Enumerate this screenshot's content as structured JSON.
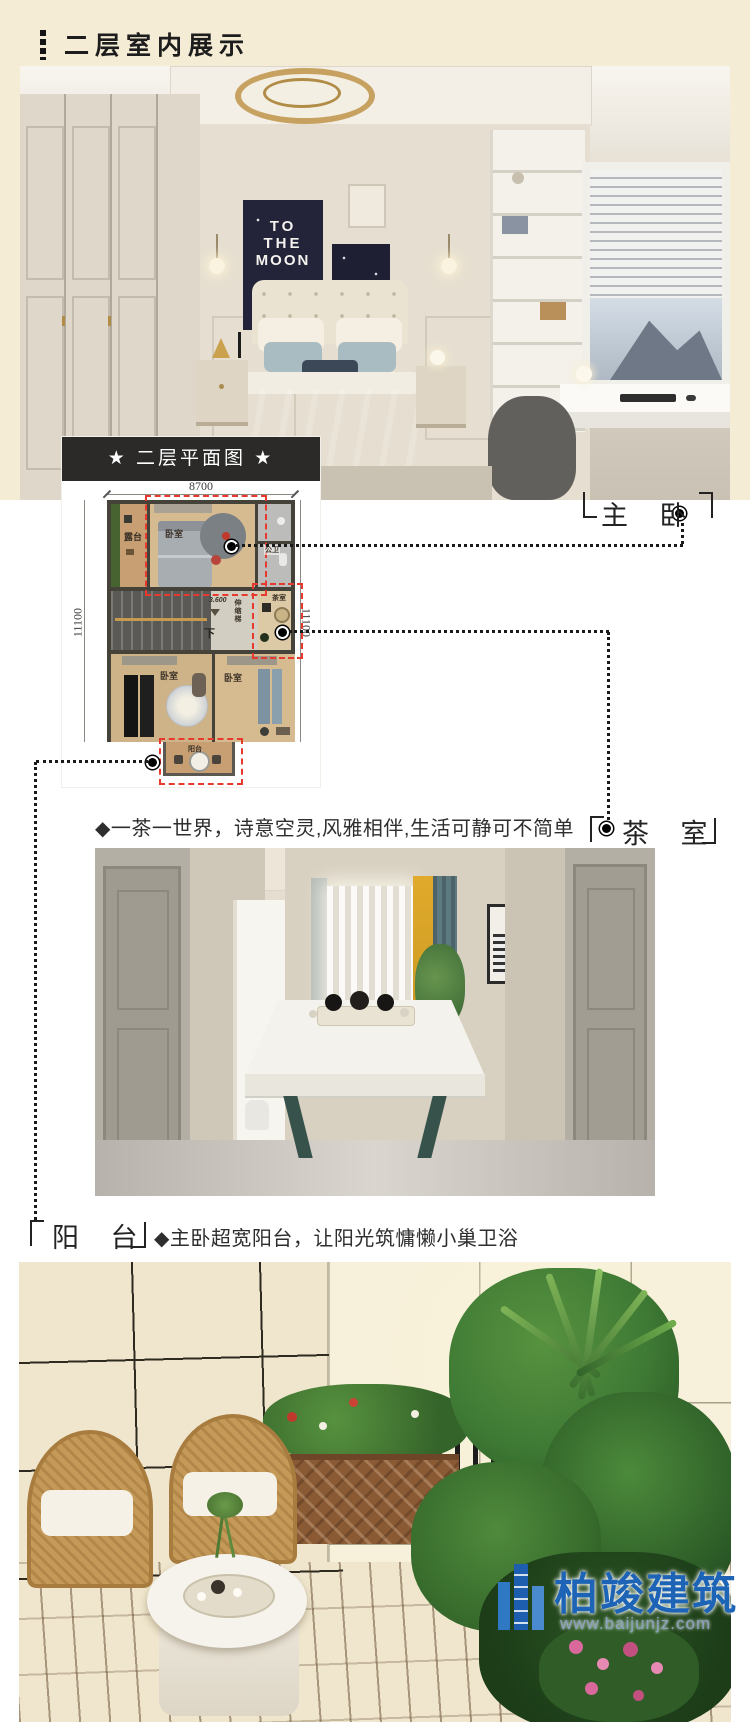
{
  "header": {
    "title": "二层室内展示"
  },
  "floorplan": {
    "title": "★ 二层平面图 ★",
    "dims": {
      "top": "8700",
      "left": "11100",
      "right": "11100"
    },
    "rooms": {
      "terrace": "露台",
      "master": "卧室",
      "bath": "公卫",
      "tea": "茶室",
      "ladder": "伸缩梯",
      "level": "3.600",
      "down": "下",
      "bedroom2": "卧室",
      "bedroom3": "卧室",
      "balcony": "阳台"
    }
  },
  "callouts": {
    "master": "主 卧",
    "tea": "茶 室",
    "balcony": "阳 台"
  },
  "captions": {
    "tea": "◆一茶一世界，诗意空灵,风雅相伴,生活可静可不简单",
    "balcony": "◆主卧超宽阳台，让阳光筑慵懒小巢卫浴"
  },
  "bedroom": {
    "poster_lines": [
      "TO",
      "THE",
      "MOON"
    ]
  },
  "watermark": {
    "brand": "柏竣建筑",
    "site": "www.baijunjz.com"
  },
  "colors": {
    "accent_red": "#e8392e",
    "label_bg": "#2b2a28",
    "page_bg": "#f5ecd6",
    "brand_blue": "#1d64b6"
  }
}
